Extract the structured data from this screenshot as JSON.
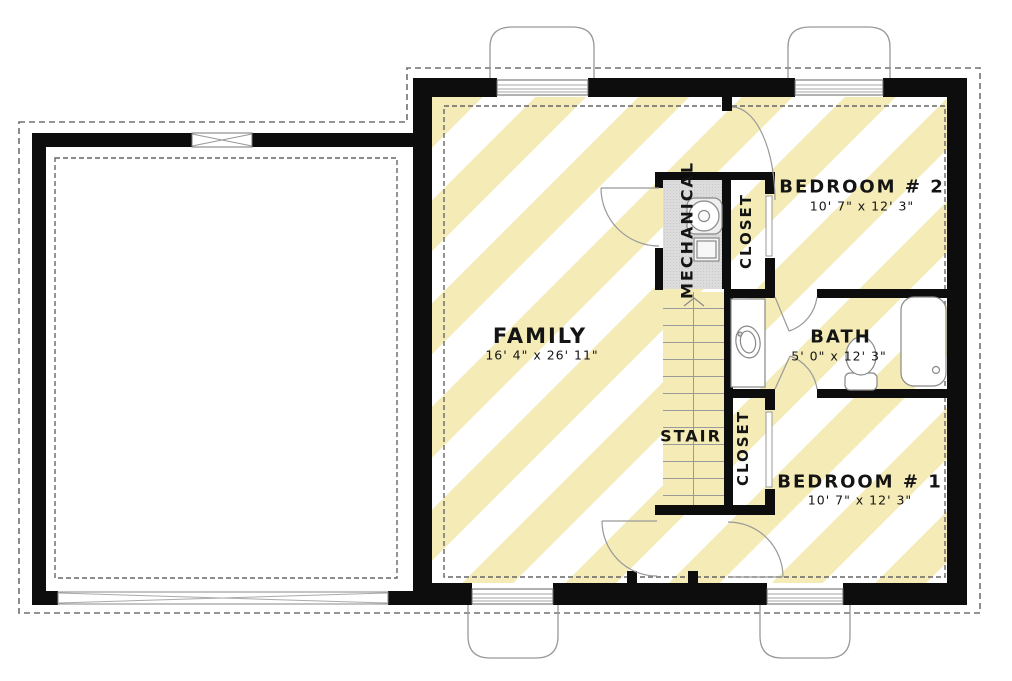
{
  "plan": {
    "rooms": {
      "family": {
        "name": "FAMILY",
        "dims": "16' 4\" x 26' 11\""
      },
      "mechanical": {
        "name": "MECHANICAL"
      },
      "closet_top": {
        "name": "CLOSET"
      },
      "bedroom2": {
        "name": "BEDROOM # 2",
        "dims": "10' 7\" x 12' 3\""
      },
      "bath": {
        "name": "BATH",
        "dims": "5' 0\" x 12' 3\""
      },
      "stair": {
        "name": "STAIR"
      },
      "closet_bottom": {
        "name": "CLOSET"
      },
      "bedroom1": {
        "name": "BEDROOM # 1",
        "dims": "10' 7\" x 12' 3\""
      }
    },
    "colors": {
      "hatch_yellow": "#f4ebb6",
      "wall_black": "#0d0d0d",
      "mechanical_gray": "#dcdcdc",
      "line_gray": "#999999",
      "dash_gray": "#707070"
    }
  }
}
